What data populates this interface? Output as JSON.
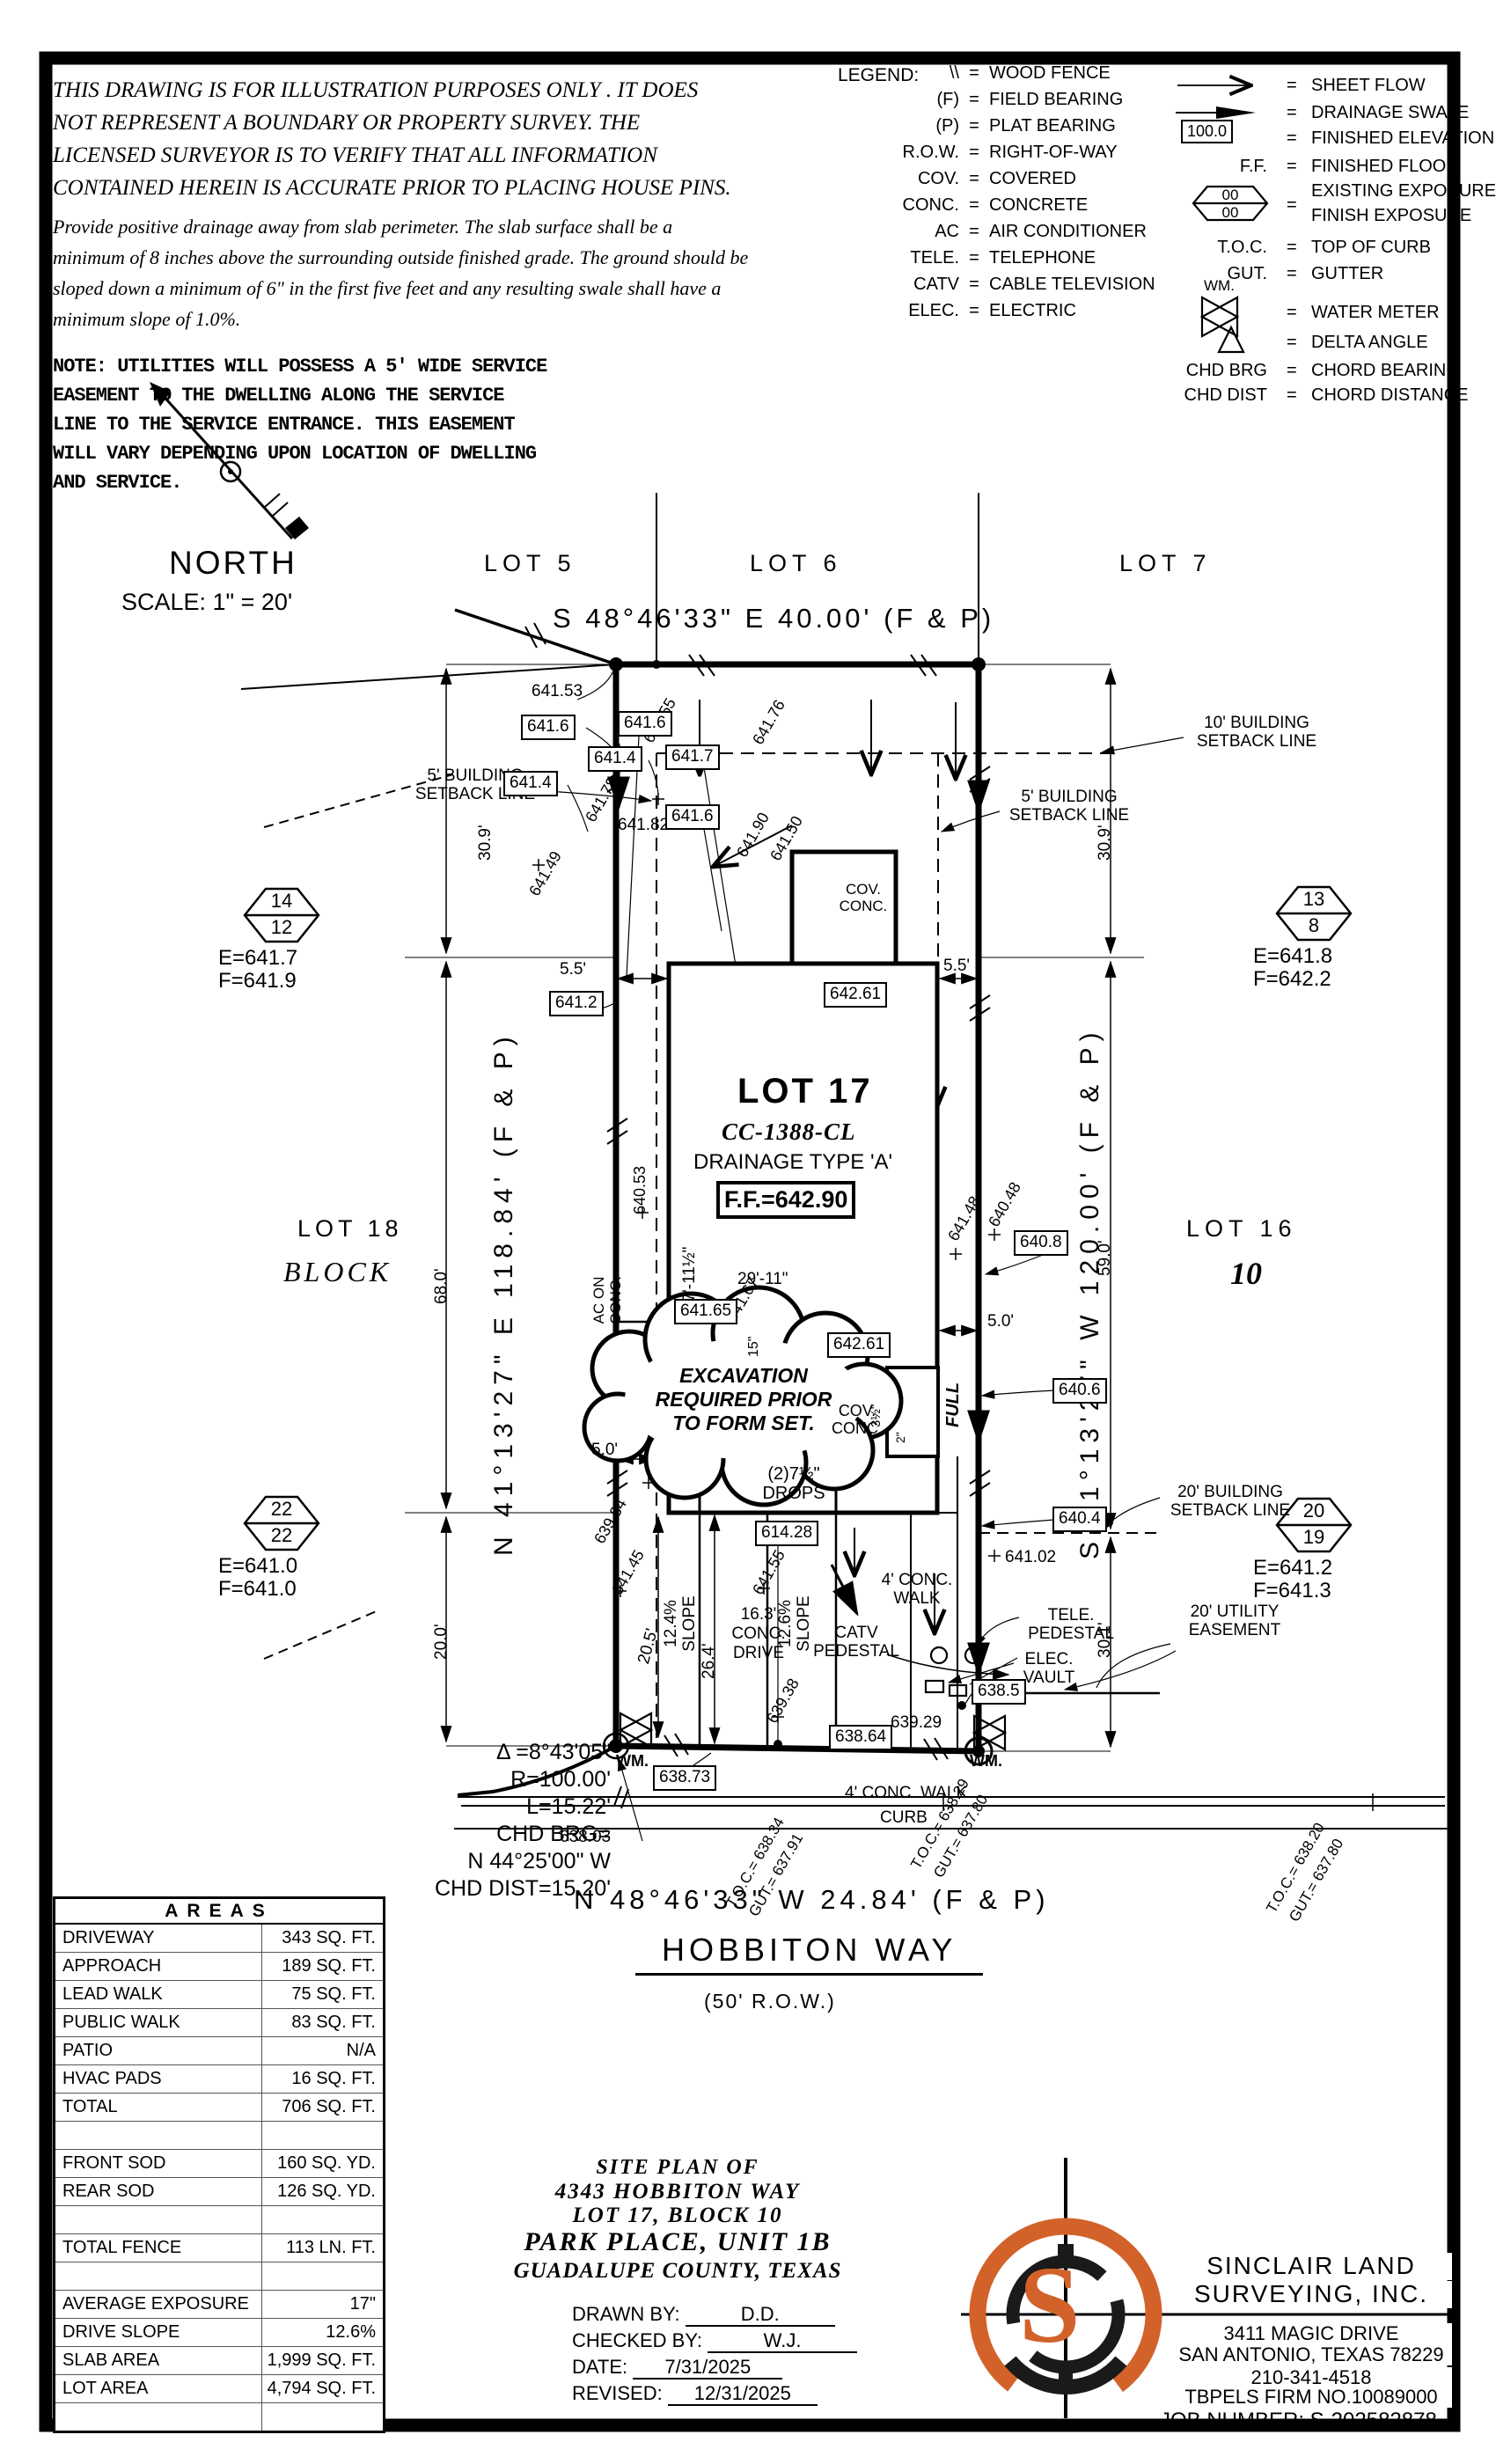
{
  "disclaimer": {
    "para1": [
      "THIS DRAWING IS FOR ILLUSTRATION PURPOSES ONLY . IT DOES",
      "NOT REPRESENT A BOUNDARY OR PROPERTY SURVEY. THE",
      "LICENSED SURVEYOR IS TO VERIFY THAT ALL INFORMATION",
      "CONTAINED HEREIN IS ACCURATE PRIOR TO PLACING HOUSE PINS."
    ],
    "para2": [
      "Provide positive drainage away from slab perimeter. The slab surface shall be a",
      "minimum of 8 inches above the surrounding outside finished grade. The ground should be",
      "sloped down a minimum of 6\" in the first five feet and any resulting swale shall have a",
      "minimum slope of 1.0%."
    ],
    "note": [
      "NOTE: UTILITIES WILL POSSESS A 5' WIDE SERVICE",
      "EASEMENT TO THE DWELLING ALONG THE SERVICE",
      "LINE TO THE SERVICE ENTRANCE. THIS EASEMENT",
      "WILL VARY DEPENDING UPON LOCATION OF DWELLING",
      "AND SERVICE."
    ]
  },
  "legend": {
    "title": "LEGEND:",
    "left": [
      {
        "sym": "\\\\",
        "label": "WOOD FENCE"
      },
      {
        "sym": "(F)",
        "label": "FIELD BEARING"
      },
      {
        "sym": "(P)",
        "label": "PLAT BEARING"
      },
      {
        "sym": "R.O.W.",
        "label": "RIGHT-OF-WAY"
      },
      {
        "sym": "COV.",
        "label": "COVERED"
      },
      {
        "sym": "CONC.",
        "label": "CONCRETE"
      },
      {
        "sym": "AC",
        "label": "AIR CONDITIONER"
      },
      {
        "sym": "TELE.",
        "label": "TELEPHONE"
      },
      {
        "sym": "CATV",
        "label": "CABLE TELEVISION"
      },
      {
        "sym": "ELEC.",
        "label": "ELECTRIC"
      }
    ],
    "right": [
      {
        "label": "SHEET FLOW"
      },
      {
        "label": "DRAINAGE SWALE"
      },
      {
        "sym": "100.0",
        "label": "FINISHED ELEVATION"
      },
      {
        "sym": "F.F.",
        "label": "FINISHED FLOOR"
      },
      {
        "top": "00",
        "bottom": "00",
        "label1": "EXISTING EXPOSURE",
        "label2": "FINISH EXPOSURE"
      },
      {
        "sym": "T.O.C.",
        "label": "TOP OF CURB"
      },
      {
        "sym": "GUT.",
        "label": "GUTTER"
      },
      {
        "sym": "WM.",
        "label": "WATER METER"
      },
      {
        "label": "DELTA ANGLE"
      },
      {
        "sym": "CHD BRG",
        "label": "CHORD BEARING"
      },
      {
        "sym": "CHD DIST",
        "label": "CHORD DISTANCE"
      }
    ]
  },
  "north": {
    "label": "NORTH",
    "scale": "SCALE: 1\" = 20'"
  },
  "lots": {
    "l5": "LOT 5",
    "l6": "LOT 6",
    "l7": "LOT 7",
    "l16": "LOT 16",
    "l17": "LOT 17",
    "l18": "LOT 18",
    "block": "BLOCK",
    "block_no": "10"
  },
  "bearing": {
    "top": "S 48°46'33\" E 40.00' (F & P)",
    "left": "N 41°13'27\" E 118.84' (F & P)",
    "right": "S 41°13'27\" W 120.00' (F & P)",
    "bottom": "N 48°46'33\" W 24.84' (F & P)"
  },
  "street": {
    "name": "HOBBITON WAY",
    "row": "(50' R.O.W.)",
    "walk": "4' CONC. WALK",
    "curb": "CURB"
  },
  "lot17": {
    "plan": "CC-1388-CL",
    "drainage": "DRAINAGE TYPE 'A'",
    "ff": "F.F.=642.90"
  },
  "curve": {
    "l1": "Δ =8°43'05\"",
    "l2": "R=100.00'",
    "l3": "L=15.22'",
    "l4": "CHD BRG=",
    "l5": "N 44°25'00\" W",
    "l6": "CHD DIST=15.20'"
  },
  "markers": {
    "m14": {
      "top": "14",
      "bottom": "12",
      "e": "E=641.7",
      "f": "F=641.9"
    },
    "m13": {
      "top": "13",
      "bottom": "8",
      "e": "E=641.8",
      "f": "F=642.2"
    },
    "m22": {
      "top": "22",
      "bottom": "22",
      "e": "E=641.0",
      "f": "F=641.0"
    },
    "m20": {
      "top": "20",
      "bottom": "19",
      "e": "E=641.2",
      "f": "F=641.3"
    }
  },
  "setback": {
    "b10": "10' BUILDING SETBACK LINE",
    "b5": "5' BUILDING SETBACK LINE",
    "b20": "20' BUILDING SETBACK LINE",
    "ue": "20' UTILITY EASEMENT"
  },
  "pl": {
    "e641_53": "641.53",
    "e641_6": "641.6",
    "e641_4": "641.4",
    "e641_7": "641.7",
    "e641_2": "641.2",
    "e641_82": "641.82",
    "e641_55": "641.55",
    "e641_76": "641.76",
    "e641_78": "641.78",
    "e641_49": "641.49",
    "e641_90": "641.90",
    "e641_50": "641.50",
    "e642_61": "642.61",
    "e640_8": "640.8",
    "e641_48": "641.48",
    "e640_48": "640.48",
    "e640_53": "640.53",
    "e641_67": "641.67",
    "e641_65": "641.65",
    "e640_6": "640.6",
    "e614_28": "614.28",
    "e640_4": "640.4",
    "e639_84": "639.84",
    "e641_45": "641.45",
    "e639_38": "639.38",
    "e641_02": "641.02",
    "e638_5": "638.5",
    "e639_29": "639.29",
    "e638_73": "638.73",
    "e638_64": "638.64",
    "e638_03": "638.03",
    "full": "FULL"
  },
  "dim": {
    "d5_5": "5.5'",
    "d30_9": "30.9'",
    "d59_0": "59.0'",
    "d30_1": "30.1'",
    "d68_0": "68.0'",
    "d20_0": "20.0'",
    "d29_11": "29'-11\"",
    "d5_0": "5.0'",
    "d26_4": "26.4'",
    "d20_5": "20.5'",
    "d77_11": "77'-11½\"",
    "d15": "15\"",
    "d3_5": "3½\"",
    "d2": "2\"",
    "s12_4": "12.4% SLOPE",
    "s12_6": "12.6% SLOPE",
    "drive": "16.3' CONC. DRIVE",
    "drops": "(2)7½\" DROPS"
  },
  "ann": {
    "ac": "AC ON CONC.",
    "cov": "COV. CONC.",
    "catv": "CATV PEDESTAL",
    "tele": "TELE. PEDESTAL",
    "elec": "ELEC. VAULT",
    "wm": "WM.",
    "ex1": "EXCAVATION",
    "ex2": "REQUIRED PRIOR",
    "ex3": "TO FORM SET."
  },
  "toc": {
    "t1": "T.O.C.= 638.34",
    "g1": "GUT.= 637.91",
    "t2": "T.O.C.= 638.29",
    "g2": "GUT.= 637.80",
    "t3": "T.O.C.= 638.20",
    "g3": "GUT.= 637.80"
  },
  "areas": {
    "title": "AREAS",
    "rows": [
      {
        "label": "DRIVEWAY",
        "value": "343 SQ. FT."
      },
      {
        "label": "APPROACH",
        "value": "189 SQ. FT."
      },
      {
        "label": "LEAD WALK",
        "value": "75 SQ. FT."
      },
      {
        "label": "PUBLIC WALK",
        "value": "83 SQ. FT."
      },
      {
        "label": "PATIO",
        "value": "N/A"
      },
      {
        "label": "HVAC PADS",
        "value": "16 SQ. FT."
      },
      {
        "label": "TOTAL",
        "value": "706 SQ. FT."
      },
      {
        "label": "",
        "value": ""
      },
      {
        "label": "FRONT SOD",
        "value": "160 SQ. YD."
      },
      {
        "label": "REAR SOD",
        "value": "126 SQ. YD."
      },
      {
        "label": "",
        "value": ""
      },
      {
        "label": "TOTAL FENCE",
        "value": "113 LN. FT."
      },
      {
        "label": "",
        "value": ""
      },
      {
        "label": "AVERAGE EXPOSURE",
        "value": "17\""
      },
      {
        "label": "DRIVE SLOPE",
        "value": "12.6%"
      },
      {
        "label": "SLAB AREA",
        "value": "1,999 SQ. FT."
      },
      {
        "label": "LOT AREA",
        "value": "4,794 SQ. FT."
      },
      {
        "label": "",
        "value": ""
      }
    ]
  },
  "title_block": {
    "l1": "SITE PLAN OF",
    "l2": "4343 HOBBITON WAY",
    "l3": "LOT 17, BLOCK 10",
    "l4": "PARK PLACE, UNIT 1B",
    "l5": "GUADALUPE COUNTY, TEXAS",
    "drawn_label": "DRAWN BY:",
    "drawn": "D.D.",
    "checked_label": "CHECKED BY:",
    "checked": "W.J.",
    "date_label": "DATE:",
    "date": "7/31/2025",
    "revised_label": "REVISED:",
    "revised": "12/31/2025"
  },
  "firm": {
    "name1": "SINCLAIR LAND",
    "name2": "SURVEYING, INC.",
    "addr1": "3411 MAGIC DRIVE",
    "addr2": "SAN ANTONIO, TEXAS 78229",
    "phone": "210-341-4518",
    "firm_no": "TBPELS FIRM NO.10089000",
    "job": "JOB NUMBER:  S-202582878",
    "logo_s": "S"
  },
  "colors": {
    "accent": "#D2622A",
    "ink": "#000000"
  },
  "misc": {
    "eq": "="
  }
}
